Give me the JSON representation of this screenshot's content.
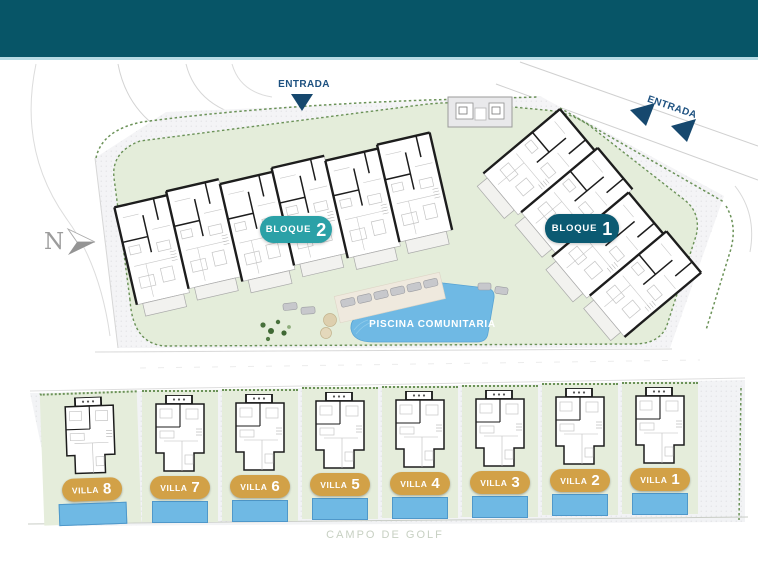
{
  "site": {
    "north_label": "N",
    "entrances": [
      {
        "label": "ENTRADA"
      },
      {
        "label": "ENTRADA"
      }
    ],
    "blocks": [
      {
        "name": "BLOQUE",
        "number": "2",
        "badge_color": "#2ba1a7"
      },
      {
        "name": "BLOQUE",
        "number": "1",
        "badge_color": "#0b5a72"
      }
    ],
    "pool": {
      "label": "PISCINA COMUNITARIA",
      "water_color": "#6fb9e4"
    },
    "villas": [
      {
        "name": "VILLA",
        "number": "8"
      },
      {
        "name": "VILLA",
        "number": "7"
      },
      {
        "name": "VILLA",
        "number": "6"
      },
      {
        "name": "VILLA",
        "number": "5"
      },
      {
        "name": "VILLA",
        "number": "4"
      },
      {
        "name": "VILLA",
        "number": "3"
      },
      {
        "name": "VILLA",
        "number": "2"
      },
      {
        "name": "VILLA",
        "number": "1"
      }
    ],
    "villa_badge_color": "#d2a147",
    "golf_label": "CAMPO DE GOLF",
    "colors": {
      "header_bar": "#075567",
      "header_accent": "#b7dbe4",
      "lawn": "#e4edda",
      "entrance_text": "#1d5180",
      "golf_text": "#c7d0c2"
    }
  }
}
